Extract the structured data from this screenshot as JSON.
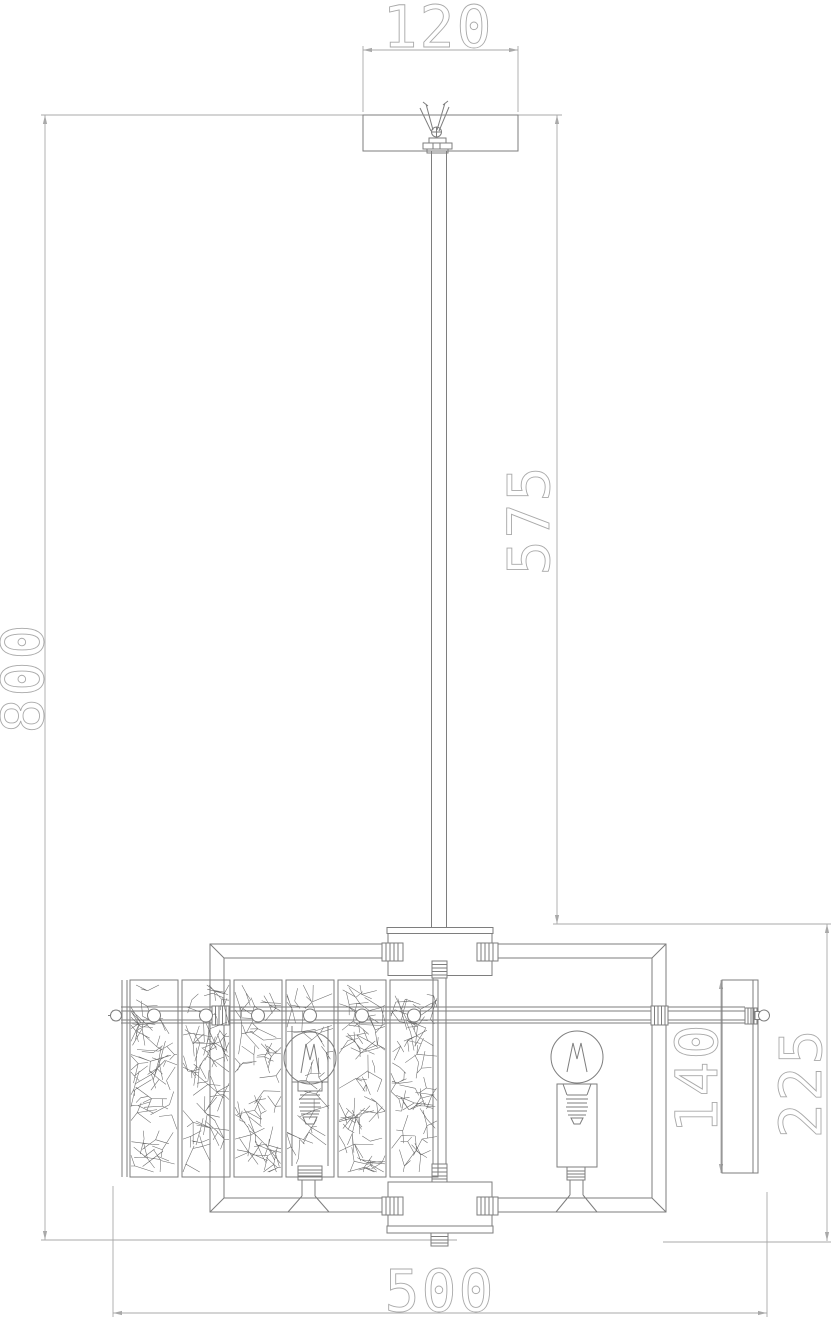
{
  "drawing": {
    "title": "pendant-chandelier-technical-drawing",
    "view": "front elevation",
    "dimensions": {
      "canopy_width": "120",
      "rod_drop": "575",
      "overall_height": "800",
      "side_panel_height": "140",
      "body_drop": "225",
      "fixture_width": "500"
    },
    "colors": {
      "background": "#ffffff",
      "outline": "#7e7e7e",
      "dimension": "#a9a9a9",
      "crackle": "#6a6a6a"
    }
  }
}
